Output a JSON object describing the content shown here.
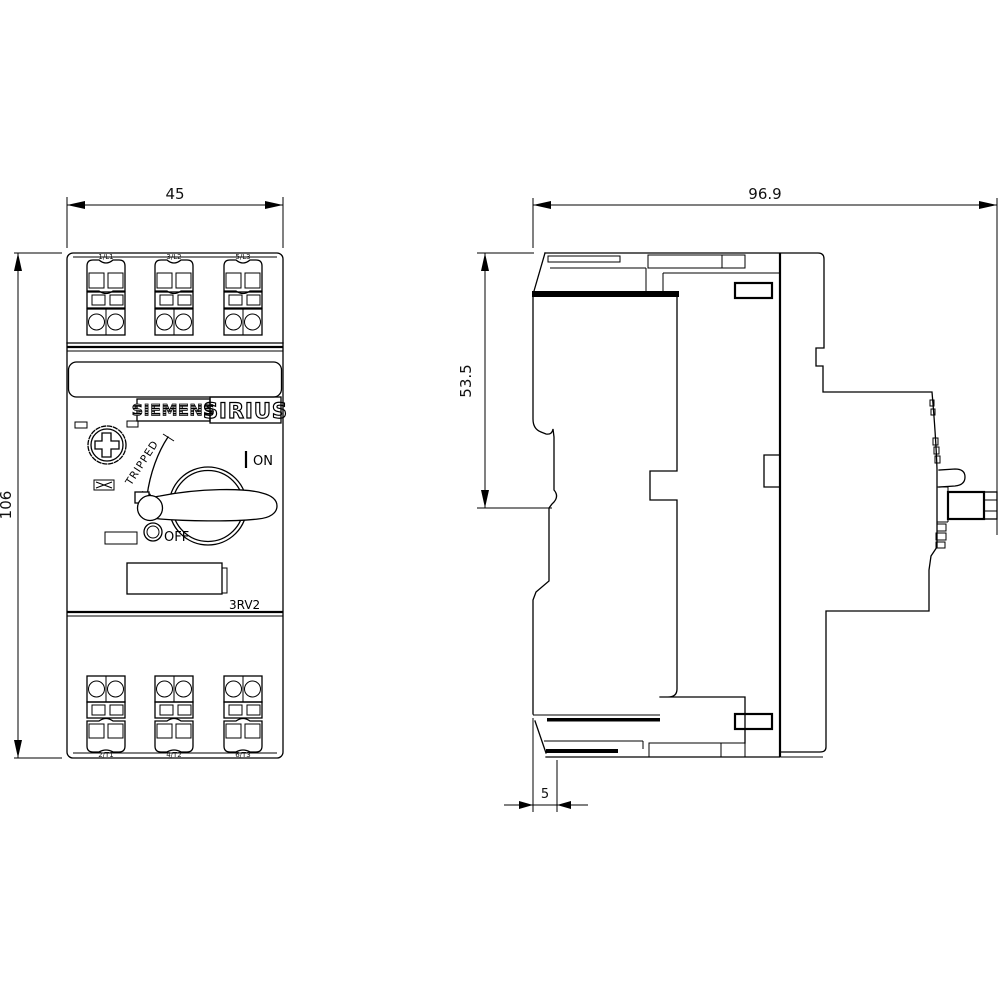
{
  "drawing": {
    "front_view": {
      "width_dim": "45",
      "height_dim": "106",
      "brand": "SIEMENS",
      "series": "SIRIUS",
      "model": "3RV2",
      "tripped_label": "TRIPPED",
      "on_label": "ON",
      "off_label": "OFF",
      "top_terminal_labels": [
        "1/L1",
        "3/L2",
        "5/L3"
      ],
      "bottom_terminal_labels": [
        "2/T1",
        "4/T2",
        "6/T3"
      ]
    },
    "side_view": {
      "depth_dim": "96.9",
      "upper_depth_dim": "53.5",
      "rail_offset_dim": "5"
    },
    "colors": {
      "line": "#000000",
      "background": "#ffffff"
    }
  }
}
